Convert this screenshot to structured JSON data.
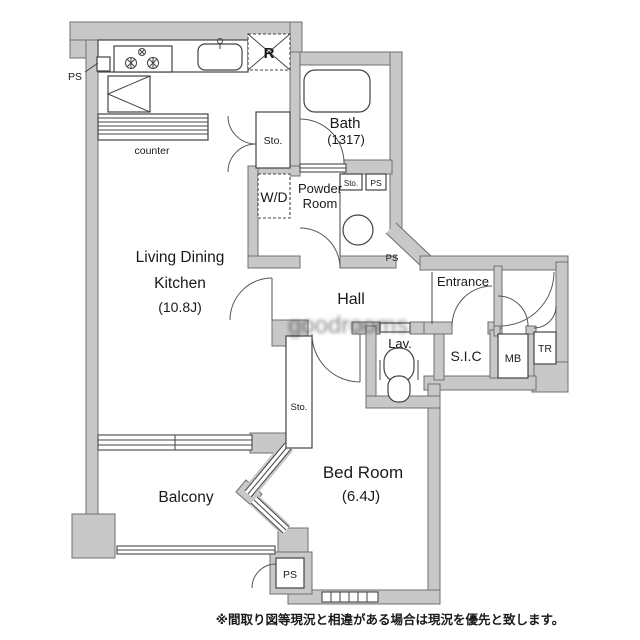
{
  "floorplan": {
    "rooms": {
      "ldk": {
        "line1": "Living Dining",
        "line2": "Kitchen",
        "size": "(10.8J)"
      },
      "bath": {
        "name": "Bath",
        "size": "(1317)"
      },
      "powder": {
        "line1": "Powder",
        "line2": "Room"
      },
      "bedroom": {
        "name": "Bed Room",
        "size": "(6.4J)"
      },
      "balcony": {
        "name": "Balcony"
      },
      "hall": {
        "name": "Hall"
      },
      "entrance": {
        "name": "Entrance"
      },
      "lav": {
        "name": "Lav."
      },
      "sic": {
        "name": "S.I.C"
      },
      "mb": {
        "name": "MB"
      },
      "tr": {
        "name": "TR"
      },
      "wd": {
        "name": "W/D"
      },
      "sto": {
        "name": "Sto."
      },
      "ps": {
        "name": "PS"
      },
      "counter": {
        "name": "counter"
      },
      "fridge": {
        "name": "R"
      }
    },
    "disclaimer": "※間取り図等現況と相違がある場合は現況を優先と致します。",
    "watermark": "goodrooms",
    "colors": {
      "wall": "#c8c8c8",
      "wall_outline": "#6f6f6f",
      "line": "#444444",
      "text": "#1a1a1a"
    }
  }
}
